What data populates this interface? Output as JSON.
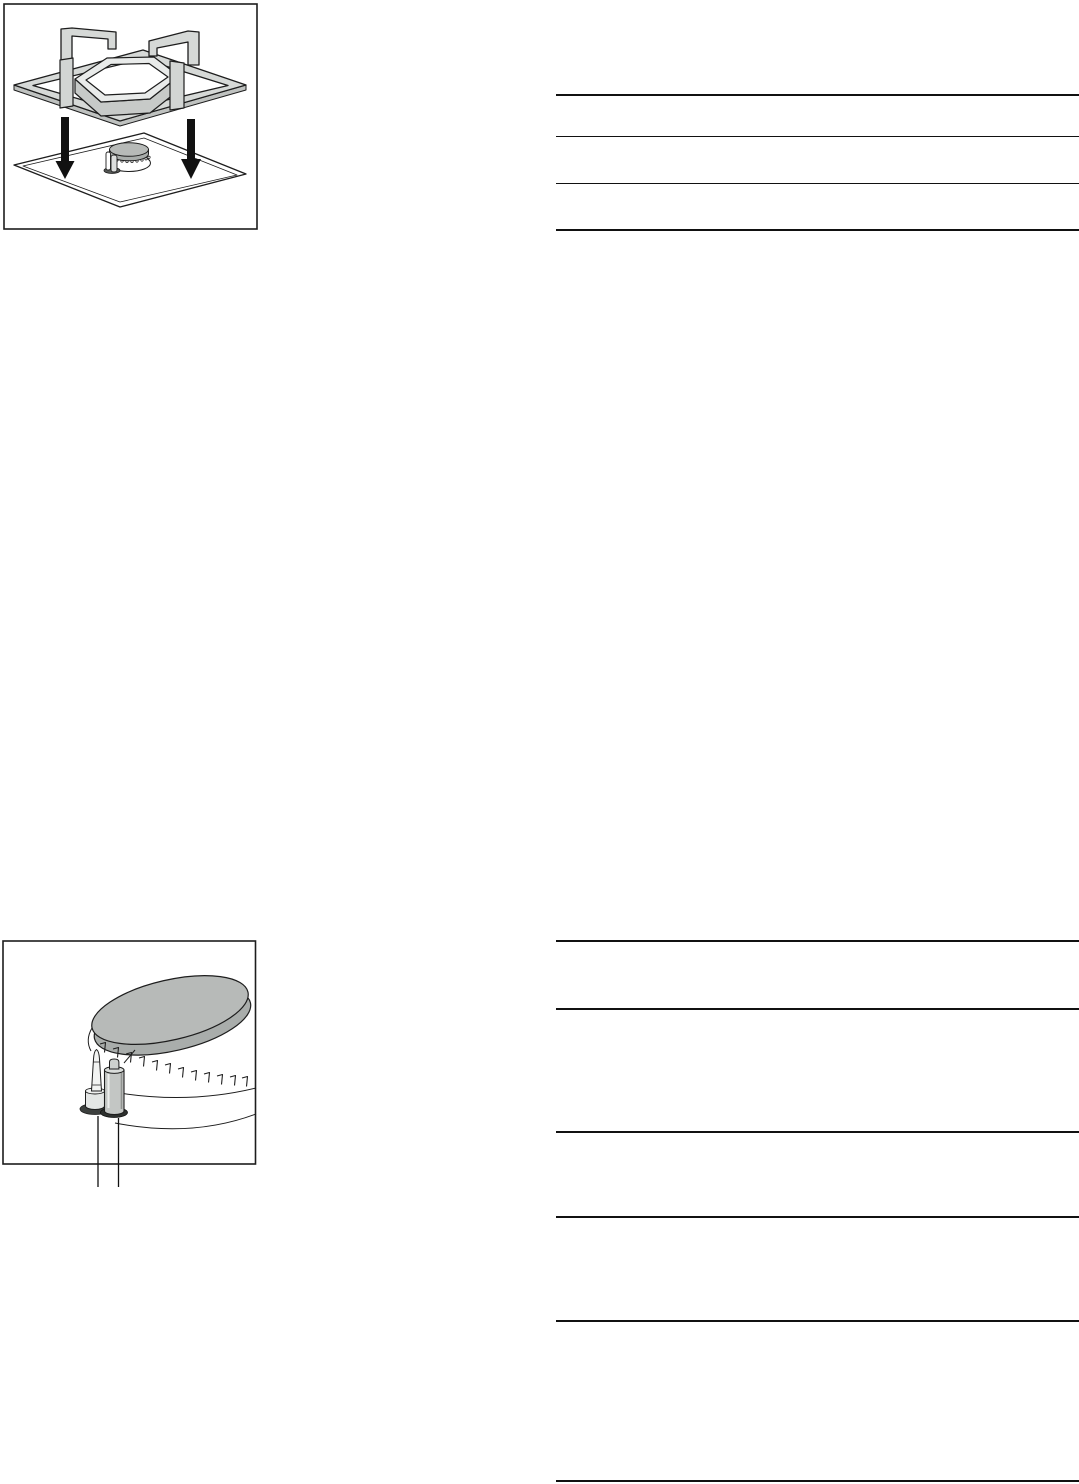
{
  "page": {
    "kind": "appliance-manual-page",
    "background": "#ffffff",
    "ink": "#111111",
    "visible_text": ""
  },
  "colors": {
    "outline": "#1d1d1d",
    "metal_light": "#d6d9d7",
    "metal_mid": "#c7cac8",
    "metal_shadow": "#bfc2c0",
    "hex_top": "#e9ebea",
    "cap_top": "#b7bab8",
    "cap_side": "#a9adab",
    "electrode_body": "#c3c6c4",
    "socket_dark": "#3c3f3d",
    "arrow_black": "#111111"
  },
  "figures": [
    {
      "name": "pan-support-placement-figure",
      "aria": "pan-support-lowered-onto-hob",
      "parts": [
        "pan-support-grid",
        "hexagon-ring",
        "support-prongs",
        "down-arrows",
        "hob-surface",
        "gas-burner"
      ]
    },
    {
      "name": "burner-detail-figure",
      "aria": "burner-close-up-thermocouple-and-ignition-electrode",
      "parts": [
        "burner-cap",
        "flame-ports",
        "burner-body",
        "thermocouple",
        "ignition-electrode",
        "part-leader-lines"
      ]
    }
  ],
  "tables": [
    {
      "name": "table-top-right",
      "row_count": 3,
      "cells_have_visible_text": false,
      "left": 556,
      "width": 523,
      "rules": [
        {
          "y": 94,
          "h": 2.4
        },
        {
          "y": 136,
          "h": 1.2
        },
        {
          "y": 183,
          "h": 1.2
        },
        {
          "y": 229,
          "h": 2.4
        }
      ]
    },
    {
      "name": "table-bottom-right",
      "row_count": 5,
      "cells_have_visible_text": false,
      "left": 556,
      "width": 523,
      "rules": [
        {
          "y": 940,
          "h": 1.5
        },
        {
          "y": 1008,
          "h": 1.5
        },
        {
          "y": 1131,
          "h": 1.7
        },
        {
          "y": 1216,
          "h": 1.8
        },
        {
          "y": 1320,
          "h": 1.5
        },
        {
          "y": 1480,
          "h": 2.0
        }
      ]
    }
  ]
}
